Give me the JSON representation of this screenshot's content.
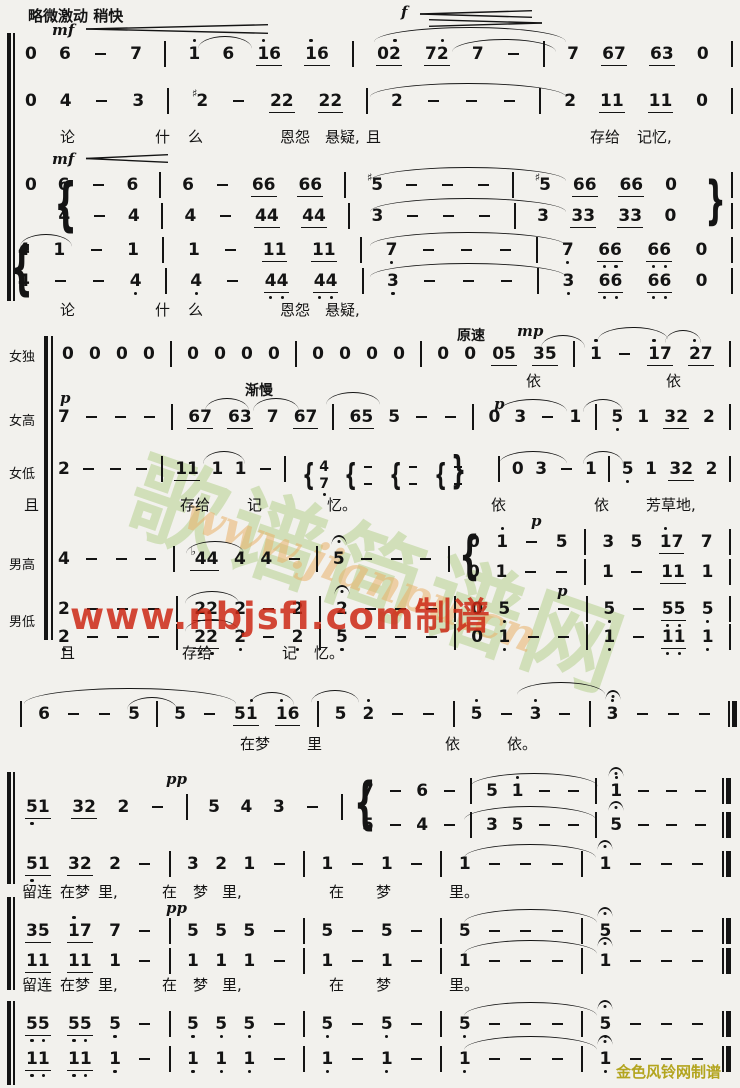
{
  "page": {
    "width": 740,
    "height": 1088,
    "background": "#f2f1ed",
    "ink": "#141414",
    "accent_red": "#cd2814",
    "accent_green": "#afcd86",
    "accent_orange": "#e9b16a",
    "accent_gold": "#b3a51f"
  },
  "watermarks": {
    "stamp": "歌谱简谱网",
    "jianpu_url": "www.jianpu.cn",
    "nbjsfl_url": "www.nbjsfl.com制谱"
  },
  "credit": {
    "text": "金色风铃网制谱"
  },
  "texts": [
    {
      "t": "略微激动  稍快",
      "x": 28,
      "y": 5,
      "c": "tempo"
    },
    {
      "t": "mf",
      "x": 52,
      "y": 21,
      "c": "dyn"
    },
    {
      "t": "f",
      "x": 401,
      "y": 3,
      "c": "dyn"
    },
    {
      "t": "mf",
      "x": 52,
      "y": 150,
      "c": "dyn"
    },
    {
      "t": "渐慢",
      "x": 245,
      "y": 380,
      "c": "tempo2"
    },
    {
      "t": "原速",
      "x": 457,
      "y": 325,
      "c": "tempo2"
    },
    {
      "t": "mp",
      "x": 517,
      "y": 322,
      "c": "dyn"
    },
    {
      "t": "p",
      "x": 60,
      "y": 389,
      "c": "dyn"
    },
    {
      "t": "p",
      "x": 494,
      "y": 395,
      "c": "dyn"
    },
    {
      "t": "p",
      "x": 531,
      "y": 512,
      "c": "dyn"
    },
    {
      "t": "p",
      "x": 557,
      "y": 582,
      "c": "dyn"
    },
    {
      "t": "pp",
      "x": 166,
      "y": 770,
      "c": "dyn"
    },
    {
      "t": "pp",
      "x": 166,
      "y": 899,
      "c": "dyn"
    },
    {
      "t": "女独",
      "x": 9,
      "y": 346,
      "c": "lab"
    },
    {
      "t": "女高",
      "x": 9,
      "y": 410,
      "c": "lab"
    },
    {
      "t": "女低",
      "x": 9,
      "y": 463,
      "c": "lab"
    },
    {
      "t": "男高",
      "x": 9,
      "y": 554,
      "c": "lab"
    },
    {
      "t": "男低",
      "x": 9,
      "y": 611,
      "c": "lab"
    },
    {
      "t": "论",
      "x": 60,
      "y": 126,
      "c": "lyr"
    },
    {
      "t": "什",
      "x": 155,
      "y": 126,
      "c": "lyr"
    },
    {
      "t": "么",
      "x": 188,
      "y": 126,
      "c": "lyr"
    },
    {
      "t": "恩怨",
      "x": 280,
      "y": 126,
      "c": "lyr"
    },
    {
      "t": "悬疑,",
      "x": 325,
      "y": 126,
      "c": "lyr"
    },
    {
      "t": "且",
      "x": 366,
      "y": 126,
      "c": "lyr"
    },
    {
      "t": "存给",
      "x": 590,
      "y": 126,
      "c": "lyr"
    },
    {
      "t": "记忆,",
      "x": 637,
      "y": 126,
      "c": "lyr"
    },
    {
      "t": "论",
      "x": 60,
      "y": 299,
      "c": "lyr"
    },
    {
      "t": "什",
      "x": 155,
      "y": 299,
      "c": "lyr"
    },
    {
      "t": "么",
      "x": 188,
      "y": 299,
      "c": "lyr"
    },
    {
      "t": "恩怨",
      "x": 280,
      "y": 299,
      "c": "lyr"
    },
    {
      "t": "悬疑,",
      "x": 325,
      "y": 299,
      "c": "lyr"
    },
    {
      "t": "依",
      "x": 526,
      "y": 370,
      "c": "lyr"
    },
    {
      "t": "依",
      "x": 666,
      "y": 370,
      "c": "lyr"
    },
    {
      "t": "且",
      "x": 24,
      "y": 494,
      "c": "lyr"
    },
    {
      "t": "存给",
      "x": 180,
      "y": 494,
      "c": "lyr"
    },
    {
      "t": "记",
      "x": 247,
      "y": 494,
      "c": "lyr"
    },
    {
      "t": "忆。",
      "x": 327,
      "y": 494,
      "c": "lyr"
    },
    {
      "t": "依",
      "x": 491,
      "y": 494,
      "c": "lyr"
    },
    {
      "t": "依",
      "x": 594,
      "y": 494,
      "c": "lyr"
    },
    {
      "t": "芳草地,",
      "x": 646,
      "y": 494,
      "c": "lyr"
    },
    {
      "t": "且",
      "x": 60,
      "y": 642,
      "c": "lyr"
    },
    {
      "t": "存给",
      "x": 182,
      "y": 642,
      "c": "lyr"
    },
    {
      "t": "记",
      "x": 282,
      "y": 642,
      "c": "lyr"
    },
    {
      "t": "忆。",
      "x": 314,
      "y": 642,
      "c": "lyr"
    },
    {
      "t": "在梦",
      "x": 240,
      "y": 733,
      "c": "lyr"
    },
    {
      "t": "里",
      "x": 307,
      "y": 733,
      "c": "lyr"
    },
    {
      "t": "依",
      "x": 445,
      "y": 733,
      "c": "lyr"
    },
    {
      "t": "依。",
      "x": 507,
      "y": 733,
      "c": "lyr"
    },
    {
      "t": "留连",
      "x": 22,
      "y": 881,
      "c": "lyr"
    },
    {
      "t": "在梦",
      "x": 60,
      "y": 881,
      "c": "lyr"
    },
    {
      "t": "里,",
      "x": 98,
      "y": 881,
      "c": "lyr"
    },
    {
      "t": "在",
      "x": 162,
      "y": 881,
      "c": "lyr"
    },
    {
      "t": "梦",
      "x": 193,
      "y": 881,
      "c": "lyr"
    },
    {
      "t": "里,",
      "x": 222,
      "y": 881,
      "c": "lyr"
    },
    {
      "t": "在",
      "x": 329,
      "y": 881,
      "c": "lyr"
    },
    {
      "t": "梦",
      "x": 376,
      "y": 881,
      "c": "lyr"
    },
    {
      "t": "里。",
      "x": 449,
      "y": 881,
      "c": "lyr"
    },
    {
      "t": "留连",
      "x": 22,
      "y": 974,
      "c": "lyr"
    },
    {
      "t": "在梦",
      "x": 60,
      "y": 974,
      "c": "lyr"
    },
    {
      "t": "里,",
      "x": 98,
      "y": 974,
      "c": "lyr"
    },
    {
      "t": "在",
      "x": 162,
      "y": 974,
      "c": "lyr"
    },
    {
      "t": "梦",
      "x": 193,
      "y": 974,
      "c": "lyr"
    },
    {
      "t": "里,",
      "x": 222,
      "y": 974,
      "c": "lyr"
    },
    {
      "t": "在",
      "x": 329,
      "y": 974,
      "c": "lyr"
    },
    {
      "t": "梦",
      "x": 376,
      "y": 974,
      "c": "lyr"
    },
    {
      "t": "里。",
      "x": 449,
      "y": 974,
      "c": "lyr"
    }
  ],
  "rows": [
    {
      "y": 45,
      "x0": 25,
      "x1": 733,
      "cells": [
        "0",
        "6",
        "-",
        "7",
        "|",
        "1'",
        "6",
        "u:1'6",
        "u:1'6",
        "|",
        "u:02'",
        "u:72'",
        "7",
        "-",
        "|",
        "7",
        "u:67",
        "u:63",
        "0",
        "|"
      ]
    },
    {
      "y": 92,
      "x0": 25,
      "x1": 733,
      "cells": [
        "0",
        "4",
        "-",
        "3",
        "|",
        "#2",
        "-",
        "u:22",
        "u:22",
        "|",
        "2",
        "-",
        "-",
        "-",
        "|",
        "2",
        "u:11",
        "u:11",
        "0",
        "|"
      ]
    },
    {
      "y": 176,
      "x0": 25,
      "x1": 733,
      "cells": [
        "0",
        "6",
        "-",
        "6",
        "|",
        "6",
        "-",
        "u:66",
        "u:66",
        "|",
        "#5",
        "-",
        "-",
        "-",
        "|",
        "#5",
        "u:66",
        "u:66",
        "0",
        ".",
        "|"
      ]
    },
    {
      "y": 207,
      "x0": 25,
      "x1": 733,
      "cells": [
        ".",
        "4",
        "-",
        "4",
        "|",
        "4",
        "-",
        "u:44",
        "u:44",
        "|",
        "3",
        "-",
        "-",
        "-",
        "|",
        "3",
        "u:33",
        "u:33",
        "0",
        ".",
        "|"
      ]
    },
    {
      "y": 241,
      "x0": 18,
      "x1": 733,
      "cells": [
        "4",
        "1",
        "-",
        "1",
        "|",
        "1",
        "-",
        "u:11",
        "u:11",
        "|",
        "7,",
        "-",
        "-",
        "-",
        "|",
        "7,",
        "u:6,6,",
        "u:6,6,",
        "0",
        "|"
      ]
    },
    {
      "y": 272,
      "x0": 18,
      "x1": 733,
      "cells": [
        "4,",
        "-",
        "-",
        "4,",
        "|",
        "4,",
        "-",
        "u:4,4,",
        "u:4,4,",
        "|",
        "3,",
        "-",
        "-",
        "-",
        "|",
        "3,",
        "u:6,6,",
        "u:6,6,",
        "0",
        "|"
      ]
    },
    {
      "y": 345,
      "x0": 62,
      "x1": 731,
      "cells": [
        "0",
        "0",
        "0",
        "0",
        "|",
        "0",
        "0",
        "0",
        "0",
        "|",
        "0",
        "0",
        "0",
        "0",
        "|",
        "0",
        "0",
        "u:05",
        "u:35",
        "|",
        "1'",
        "-",
        "u:1'7",
        "u:2'7",
        "|"
      ]
    },
    {
      "y": 408,
      "x0": 58,
      "x1": 731,
      "cells": [
        "7",
        "-",
        "-",
        "-",
        "|",
        "u:67",
        "u:63",
        "7",
        "u:67",
        "|",
        "u:65",
        "5",
        "-",
        "-",
        "|",
        "0",
        "3",
        "-",
        "1",
        "|",
        "5,",
        "1",
        "u:32",
        "2",
        "|"
      ]
    },
    {
      "y": 460,
      "x0": 58,
      "x1": 731,
      "cells": [
        "2",
        "-",
        "-",
        "-",
        "|",
        "u:11",
        "1",
        "1",
        "-",
        "|",
        "c:4/7,",
        "c:-/-",
        "c:-/-",
        "c:-/-",
        ".",
        "|",
        "0",
        "3",
        "-",
        "1",
        "|",
        "5,",
        "1",
        "u:32",
        "2",
        "|"
      ]
    },
    {
      "y": 550,
      "x0": 58,
      "x1": 450,
      "cells": [
        "4",
        "-",
        "-",
        "-",
        "|",
        "u:b44",
        "4",
        "4",
        "-",
        "|",
        "5^",
        "-",
        "-",
        "-",
        "|"
      ]
    },
    {
      "y": 533,
      "x0": 468,
      "x1": 731,
      "cells": [
        "0",
        "1'",
        "-",
        "5",
        "|",
        "3",
        "5",
        "u:1'7",
        "7",
        "|"
      ]
    },
    {
      "y": 563,
      "x0": 468,
      "x1": 731,
      "cells": [
        "0",
        "1",
        "-",
        "-",
        "|",
        "1",
        "-",
        "u:11",
        "1",
        "|"
      ]
    },
    {
      "y": 600,
      "x0": 58,
      "x1": 731,
      "cells": [
        "2",
        "-",
        "-",
        "-",
        "|",
        "u:22",
        "2",
        "-",
        "2",
        "|",
        "2^",
        "-",
        "-",
        "-",
        "|",
        "0",
        "5,",
        "-",
        "-",
        "|",
        "5,",
        "-",
        "u:5,5,",
        "5,",
        "|"
      ]
    },
    {
      "y": 628,
      "x0": 58,
      "x1": 731,
      "cells": [
        "2,",
        "-",
        "-",
        "-",
        "|",
        "u:2,2,",
        "2,",
        "-",
        "2,",
        "|",
        "5,",
        "-",
        "-",
        "-",
        "|",
        "0",
        "1,",
        "-",
        "-",
        "|",
        "1,",
        "-",
        "u:1,1,",
        "1,",
        "|"
      ]
    },
    {
      "y": 705,
      "x0": 20,
      "x1": 737,
      "cells": [
        "|",
        "6",
        "-",
        "-",
        "5",
        "|",
        "5",
        "-",
        "u:51'",
        "u:1'6",
        "|",
        "5",
        "2'",
        "-",
        "-",
        "|",
        "5'",
        "-",
        "3'",
        "-",
        "|",
        "3'^",
        "-",
        "-",
        "-",
        "||"
      ]
    },
    {
      "y": 798,
      "x0": 25,
      "x1": 343,
      "cells": [
        "u:5,1",
        "u:32",
        "2",
        "-",
        "|",
        "5",
        "4",
        "3",
        "-",
        "|"
      ]
    },
    {
      "y": 782,
      "x0": 362,
      "x1": 731,
      "cells": [
        "7",
        "-",
        "6",
        "-",
        "|",
        "5",
        "1'",
        "-",
        "-",
        "|",
        "1'^",
        "-",
        "-",
        "-",
        "||"
      ]
    },
    {
      "y": 816,
      "x0": 362,
      "x1": 731,
      "cells": [
        "5",
        "-",
        "4",
        "-",
        "|",
        "3",
        "5",
        "-",
        "-",
        "|",
        "5^",
        "-",
        "-",
        "-",
        "||"
      ]
    },
    {
      "y": 855,
      "x0": 25,
      "x1": 731,
      "cells": [
        "u:5,1",
        "u:32",
        "2",
        "-",
        "|",
        "3",
        "2",
        "1",
        "-",
        "|",
        "1",
        "-",
        "1",
        "-",
        "|",
        "1",
        "-",
        "-",
        "-",
        "|",
        "1^",
        "-",
        "-",
        "-",
        "||"
      ]
    },
    {
      "y": 922,
      "x0": 25,
      "x1": 731,
      "cells": [
        "u:35",
        "u:1'7",
        "7",
        "-",
        "|",
        "5",
        "5",
        "5",
        "-",
        "|",
        "5",
        "-",
        "5",
        "-",
        "|",
        "5",
        "-",
        "-",
        "-",
        "|",
        "5^",
        "-",
        "-",
        "-",
        "||"
      ]
    },
    {
      "y": 952,
      "x0": 25,
      "x1": 731,
      "cells": [
        "u:11",
        "u:11",
        "1",
        "-",
        "|",
        "1",
        "1",
        "1",
        "-",
        "|",
        "1",
        "-",
        "1",
        "-",
        "|",
        "1",
        "-",
        "-",
        "-",
        "|",
        "1^",
        "-",
        "-",
        "-",
        "||"
      ]
    },
    {
      "y": 1015,
      "x0": 25,
      "x1": 731,
      "cells": [
        "u:5,5,",
        "u:5,5,",
        "5,",
        "-",
        "|",
        "5,",
        "5,",
        "5,",
        "-",
        "|",
        "5,",
        "-",
        "5,",
        "-",
        "|",
        "5,",
        "-",
        "-",
        "-",
        "|",
        "5,^",
        "-",
        "-",
        "-",
        "||"
      ]
    },
    {
      "y": 1050,
      "x0": 25,
      "x1": 731,
      "cells": [
        "u:1,1,",
        "u:1,1,",
        "1,",
        "-",
        "|",
        "1,",
        "1,",
        "1,",
        "-",
        "|",
        "1,",
        "-",
        "1,",
        "-",
        "|",
        "1,",
        "-",
        "-",
        "-",
        "|",
        "1,^",
        "-",
        "-",
        "-",
        "||"
      ]
    }
  ],
  "arcs": [
    {
      "x": 198,
      "y": 36,
      "w": 54
    },
    {
      "x": 374,
      "y": 27,
      "w": 192,
      "h": 14
    },
    {
      "x": 452,
      "y": 39,
      "w": 104
    },
    {
      "x": 370,
      "y": 83,
      "w": 196,
      "h": 13
    },
    {
      "x": 370,
      "y": 167,
      "w": 196,
      "h": 13
    },
    {
      "x": 370,
      "y": 198,
      "w": 196,
      "h": 13
    },
    {
      "x": 20,
      "y": 234,
      "w": 52
    },
    {
      "x": 370,
      "y": 232,
      "w": 196,
      "h": 13
    },
    {
      "x": 370,
      "y": 263,
      "w": 196,
      "h": 13
    },
    {
      "x": 541,
      "y": 335,
      "w": 44
    },
    {
      "x": 598,
      "y": 327,
      "w": 70
    },
    {
      "x": 665,
      "y": 330,
      "w": 36
    },
    {
      "x": 205,
      "y": 398,
      "w": 44
    },
    {
      "x": 253,
      "y": 398,
      "w": 46
    },
    {
      "x": 326,
      "y": 392,
      "w": 54
    },
    {
      "x": 499,
      "y": 399,
      "w": 68
    },
    {
      "x": 583,
      "y": 399,
      "w": 40
    },
    {
      "x": 203,
      "y": 451,
      "w": 42
    },
    {
      "x": 499,
      "y": 451,
      "w": 68
    },
    {
      "x": 583,
      "y": 451,
      "w": 40
    },
    {
      "x": 186,
      "y": 541,
      "w": 58
    },
    {
      "x": 185,
      "y": 591,
      "w": 54
    },
    {
      "x": 185,
      "y": 619,
      "w": 54
    },
    {
      "x": 24,
      "y": 688,
      "w": 212,
      "h": 15
    },
    {
      "x": 127,
      "y": 697,
      "w": 50
    },
    {
      "x": 250,
      "y": 692,
      "w": 44
    },
    {
      "x": 311,
      "y": 690,
      "w": 48
    },
    {
      "x": 517,
      "y": 682,
      "w": 88
    },
    {
      "x": 470,
      "y": 773,
      "w": 128,
      "h": 13
    },
    {
      "x": 464,
      "y": 806,
      "w": 132,
      "h": 13
    },
    {
      "x": 464,
      "y": 844,
      "w": 132,
      "h": 13
    },
    {
      "x": 464,
      "y": 909,
      "w": 133,
      "h": 13
    },
    {
      "x": 464,
      "y": 940,
      "w": 133,
      "h": 13
    },
    {
      "x": 464,
      "y": 1002,
      "w": 133,
      "h": 13
    },
    {
      "x": 464,
      "y": 1036,
      "w": 133,
      "h": 13
    }
  ],
  "hairpins": [
    {
      "x": 86,
      "y": 24,
      "w": 182,
      "h": 10,
      "d": "c"
    },
    {
      "x": 420,
      "y": 10,
      "w": 112,
      "h": 8,
      "d": "c"
    },
    {
      "x": 429,
      "y": 19,
      "w": 113,
      "h": 8,
      "d": "d"
    },
    {
      "x": 86,
      "y": 154,
      "w": 82,
      "h": 9,
      "d": "c"
    }
  ],
  "braces": [
    {
      "x": 45,
      "y": 175,
      "h": 58,
      "t": "{"
    },
    {
      "x": 1,
      "y": 239,
      "h": 58,
      "t": "{"
    },
    {
      "x": 697,
      "y": 175,
      "h": 52,
      "t": "}"
    },
    {
      "x": 445,
      "y": 451,
      "h": 38,
      "t": "}"
    },
    {
      "x": 451,
      "y": 530,
      "h": 52,
      "t": "{"
    },
    {
      "x": 345,
      "y": 776,
      "h": 56,
      "t": "{"
    }
  ],
  "sysbars": [
    {
      "x": 7,
      "y": 33,
      "w": 4,
      "h": 268
    },
    {
      "x": 13,
      "y": 33,
      "w": 2,
      "h": 268
    },
    {
      "x": 44,
      "y": 336,
      "w": 4,
      "h": 304
    },
    {
      "x": 51,
      "y": 336,
      "w": 2,
      "h": 304
    },
    {
      "x": 7,
      "y": 772,
      "w": 4,
      "h": 112
    },
    {
      "x": 13,
      "y": 772,
      "w": 2,
      "h": 112
    },
    {
      "x": 7,
      "y": 897,
      "w": 4,
      "h": 93
    },
    {
      "x": 13,
      "y": 897,
      "w": 2,
      "h": 93
    },
    {
      "x": 7,
      "y": 1001,
      "w": 4,
      "h": 84
    },
    {
      "x": 13,
      "y": 1001,
      "w": 2,
      "h": 84
    }
  ]
}
